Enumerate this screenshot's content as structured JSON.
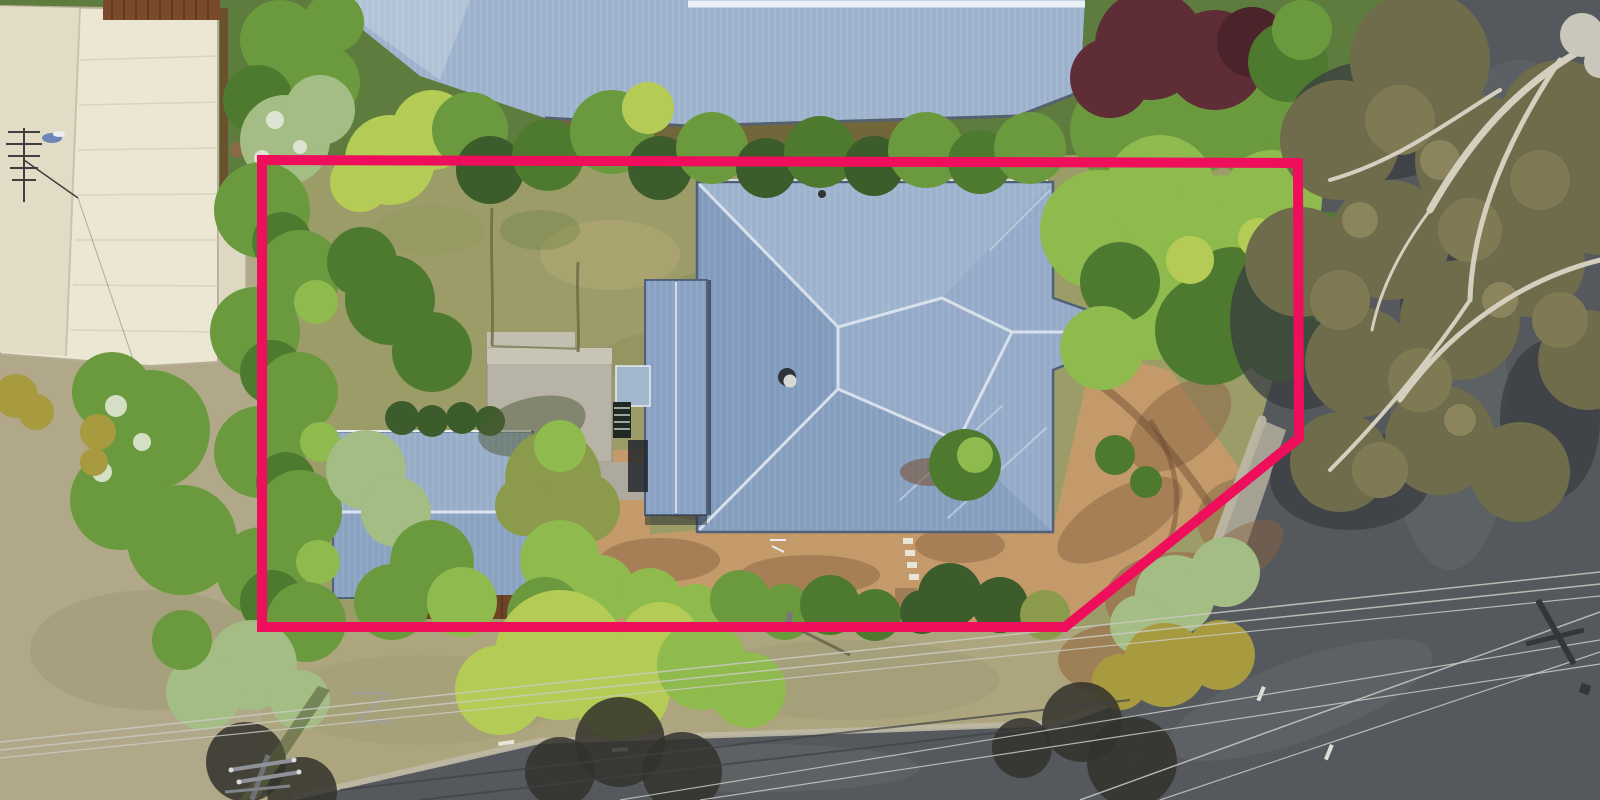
{
  "image": {
    "kind": "aerial-drone-photograph",
    "subject": "top-down view of a residential lot with a house, garage, gardens, neighbouring roofs, streets and a highlighted property boundary",
    "text_content": "none"
  },
  "boundary": {
    "label": "property-boundary-outline",
    "shape": "polygon",
    "points": "262,160 1298,163 1299,438 1065,627 262,627",
    "color": "#ef0e5c",
    "stroke_width": 10
  },
  "colors": {
    "boundary_pink": "#ef0e5c",
    "roof_main": "#8fa7c6",
    "roof_neighbor_top": "#9fb4ce",
    "roof_garage": "#8ca4c3",
    "roof_wing": "#8aa2c4",
    "roof_cream": "#ece7d4",
    "roof_cream_shade": "#ded8c2",
    "road_asphalt": "#55595d",
    "road_light": "#6a6f73",
    "grass_backyard": "#9c9c68",
    "grass_verge": "#aca57e",
    "grass_left": "#b0a888",
    "dirt_tan": "#c49a6a",
    "dirt_dark": "#9c7c52",
    "concrete": "#b7b3a6",
    "timber_deck": "#7b4a2b",
    "retaining_wall": "#6e4326",
    "foliage_backdrop": "#5e7c3e"
  },
  "scene": {
    "regions": [
      {
        "name": "subject-house-roof",
        "desc": "large hipped blue-grey metal roof"
      },
      {
        "name": "garage-roof",
        "desc": "smaller blue-grey gabled roof inside boundary"
      },
      {
        "name": "neighbor-roof-top",
        "desc": "neighbouring blue metal roof along top edge"
      },
      {
        "name": "neighbor-building-cream",
        "desc": "cream flat roof with TV antenna, top left"
      },
      {
        "name": "gum-tree-canopy",
        "desc": "large eucalyptus crown over right-hand road"
      },
      {
        "name": "road-right",
        "desc": "asphalt street on right side"
      },
      {
        "name": "road-bottom",
        "desc": "asphalt street along bottom with power lines"
      },
      {
        "name": "backyard-lawn",
        "desc": "dry patchy lawn inside boundary"
      },
      {
        "name": "front-yard-mulch",
        "desc": "tan dirt and mulch with shrubs"
      },
      {
        "name": "power-pole",
        "desc": "utility pole on bottom-left verge"
      }
    ]
  }
}
